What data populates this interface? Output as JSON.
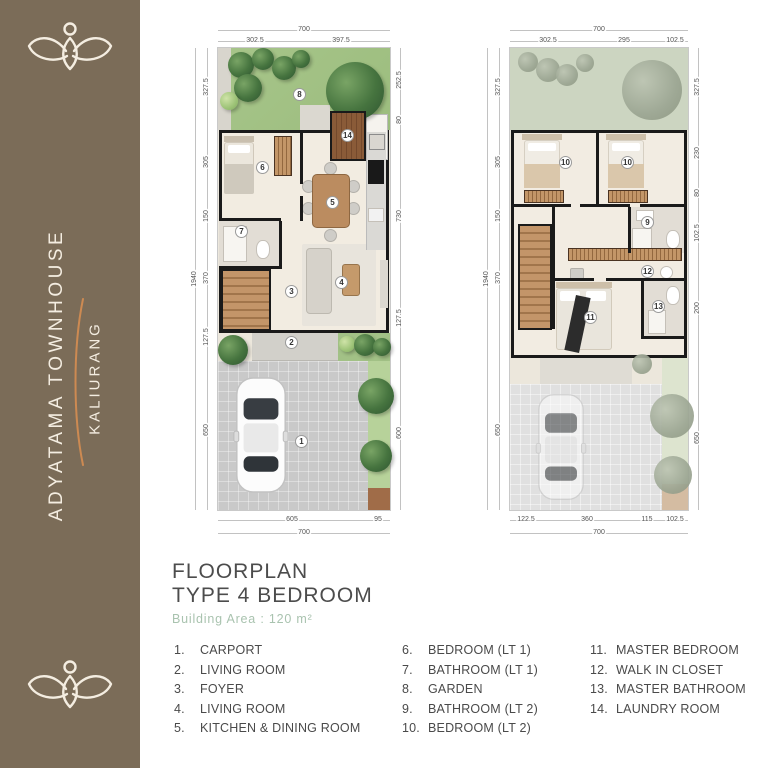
{
  "brand": {
    "name": "ADYATAMA TOWNHOUSE",
    "location": "KALIURANG",
    "sidebar_color": "#7b6c58",
    "accent_color": "#cd8a52",
    "logo": "lotus-person-mark"
  },
  "title_block": {
    "line1": "FLOORPLAN",
    "line2": "TYPE 4 BEDROOM",
    "area_label": "Building Area : 120 m²",
    "area_color": "#a9c3af"
  },
  "legend": {
    "columns": [
      {
        "items": [
          {
            "num": "1.",
            "label": "CARPORT"
          },
          {
            "num": "2.",
            "label": "LIVING ROOM"
          },
          {
            "num": "3.",
            "label": "FOYER"
          },
          {
            "num": "4.",
            "label": "LIVING ROOM"
          },
          {
            "num": "5.",
            "label": "KITCHEN & DINING ROOM"
          }
        ]
      },
      {
        "items": [
          {
            "num": "6.",
            "label": "BEDROOM (LT 1)"
          },
          {
            "num": "7.",
            "label": "BATHROOM (LT 1)"
          },
          {
            "num": "8.",
            "label": "GARDEN"
          },
          {
            "num": "9.",
            "label": "BATHROOM (LT 2)"
          },
          {
            "num": "10.",
            "label": "BEDROOM (LT 2)"
          }
        ]
      },
      {
        "items": [
          {
            "num": "11.",
            "label": "MASTER BEDROOM"
          },
          {
            "num": "12.",
            "label": "WALK IN CLOSET"
          },
          {
            "num": "13.",
            "label": "MASTER BATHROOM"
          },
          {
            "num": "14.",
            "label": "LAUNDRY ROOM"
          }
        ]
      }
    ]
  },
  "plans": {
    "left": {
      "label": "first floor plan",
      "markers": {
        "garden": "8",
        "laundry": "14",
        "bedroom": "6",
        "kitchen": "5",
        "bathroom": "7",
        "foyer": "3",
        "living": "4",
        "terrace": "2",
        "carport": "1"
      },
      "dims": {
        "top_total": "700",
        "top": [
          "302.5",
          "397.5"
        ],
        "bottom": [
          "605",
          "95"
        ],
        "bottom_total": "700",
        "left": [
          "327.5",
          "305",
          "150",
          "370",
          "127.5",
          "650"
        ],
        "left_total": "1940",
        "right": [
          "252.5",
          "80",
          "730",
          "127.5",
          "600"
        ]
      }
    },
    "right": {
      "label": "second floor plan",
      "markers": {
        "bedroom_a": "10",
        "bedroom_b": "10",
        "bathroom": "9",
        "closet": "12",
        "master_bedroom": "11",
        "master_bathroom": "13"
      },
      "dims": {
        "top_total": "700",
        "top": [
          "302.5",
          "295",
          "102.5"
        ],
        "bottom": [
          "122.5",
          "360",
          "115",
          "102.5"
        ],
        "bottom_total": "700",
        "left": [
          "327.5",
          "305",
          "150",
          "370",
          "650"
        ],
        "left_total": "1940",
        "right": [
          "327.5",
          "230",
          "80",
          "102.5",
          "200",
          "650"
        ]
      }
    }
  }
}
